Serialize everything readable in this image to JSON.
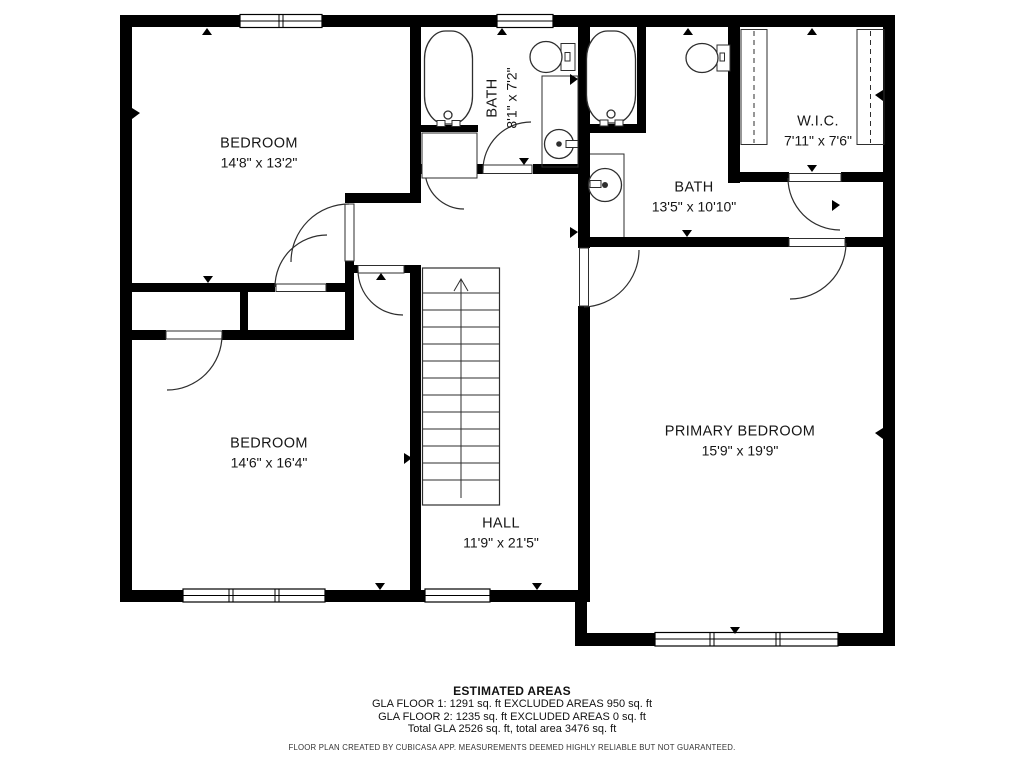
{
  "floor_plan": {
    "rooms": {
      "bedroom_top_left": {
        "name": "BEDROOM",
        "dims": "14'8\" x 13'2\""
      },
      "bath_small": {
        "name": "BATH",
        "dims": "8'1\" x 7'2\""
      },
      "wic": {
        "name": "W.I.C.",
        "dims": "7'11\" x 7'6\""
      },
      "bath_primary": {
        "name": "BATH",
        "dims": "13'5\" x 10'10\""
      },
      "bedroom_bottom_left": {
        "name": "BEDROOM",
        "dims": "14'6\" x 16'4\""
      },
      "primary_bedroom": {
        "name": "PRIMARY BEDROOM",
        "dims": "15'9\" x 19'9\""
      },
      "hall": {
        "name": "HALL",
        "dims": "11'9\" x 21'5\""
      }
    },
    "footer": {
      "title": "ESTIMATED AREAS",
      "line1": "GLA FLOOR 1: 1291 sq. ft EXCLUDED AREAS 950 sq. ft",
      "line2": "GLA FLOOR 2: 1235 sq. ft EXCLUDED AREAS 0 sq. ft",
      "line3": "Total GLA 2526 sq. ft, total area 3476 sq. ft",
      "disclaimer": "FLOOR PLAN CREATED BY CUBICASA APP. MEASUREMENTS DEEMED HIGHLY RELIABLE BUT NOT GUARANTEED."
    },
    "colors": {
      "wall": "#000000",
      "line": "#2e2e2e",
      "background": "#ffffff"
    }
  }
}
